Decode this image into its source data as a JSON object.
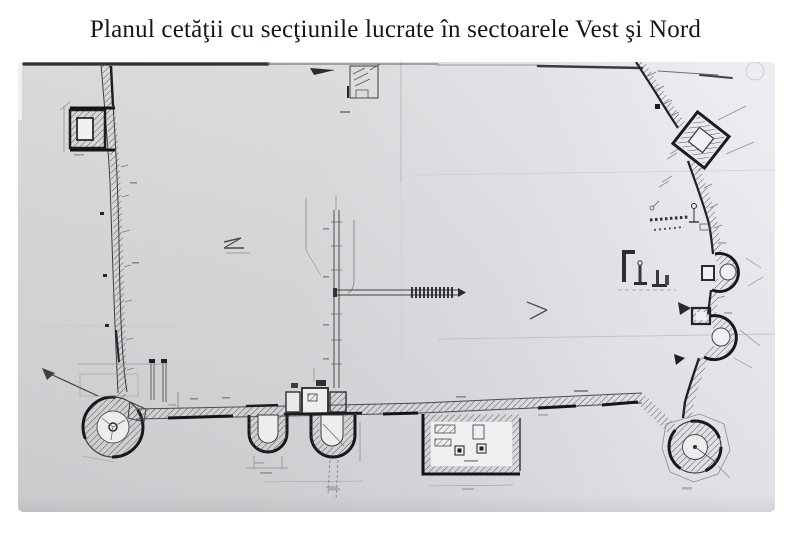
{
  "slide": {
    "title": "Planul cetăţii cu secţiunile lucrate în sectoarele Vest şi Nord"
  },
  "scan": {
    "subject": "fortress-plan-scan"
  },
  "colors": {
    "slide_background": "#ffffff",
    "title_text": "#1b1512",
    "paper_light": "#eef0f5",
    "paper_dark": "#d6d7d9",
    "ink_heavy": "#17181b",
    "ink": "#3a3b3f",
    "ink_faint": "#9a9b9f"
  }
}
